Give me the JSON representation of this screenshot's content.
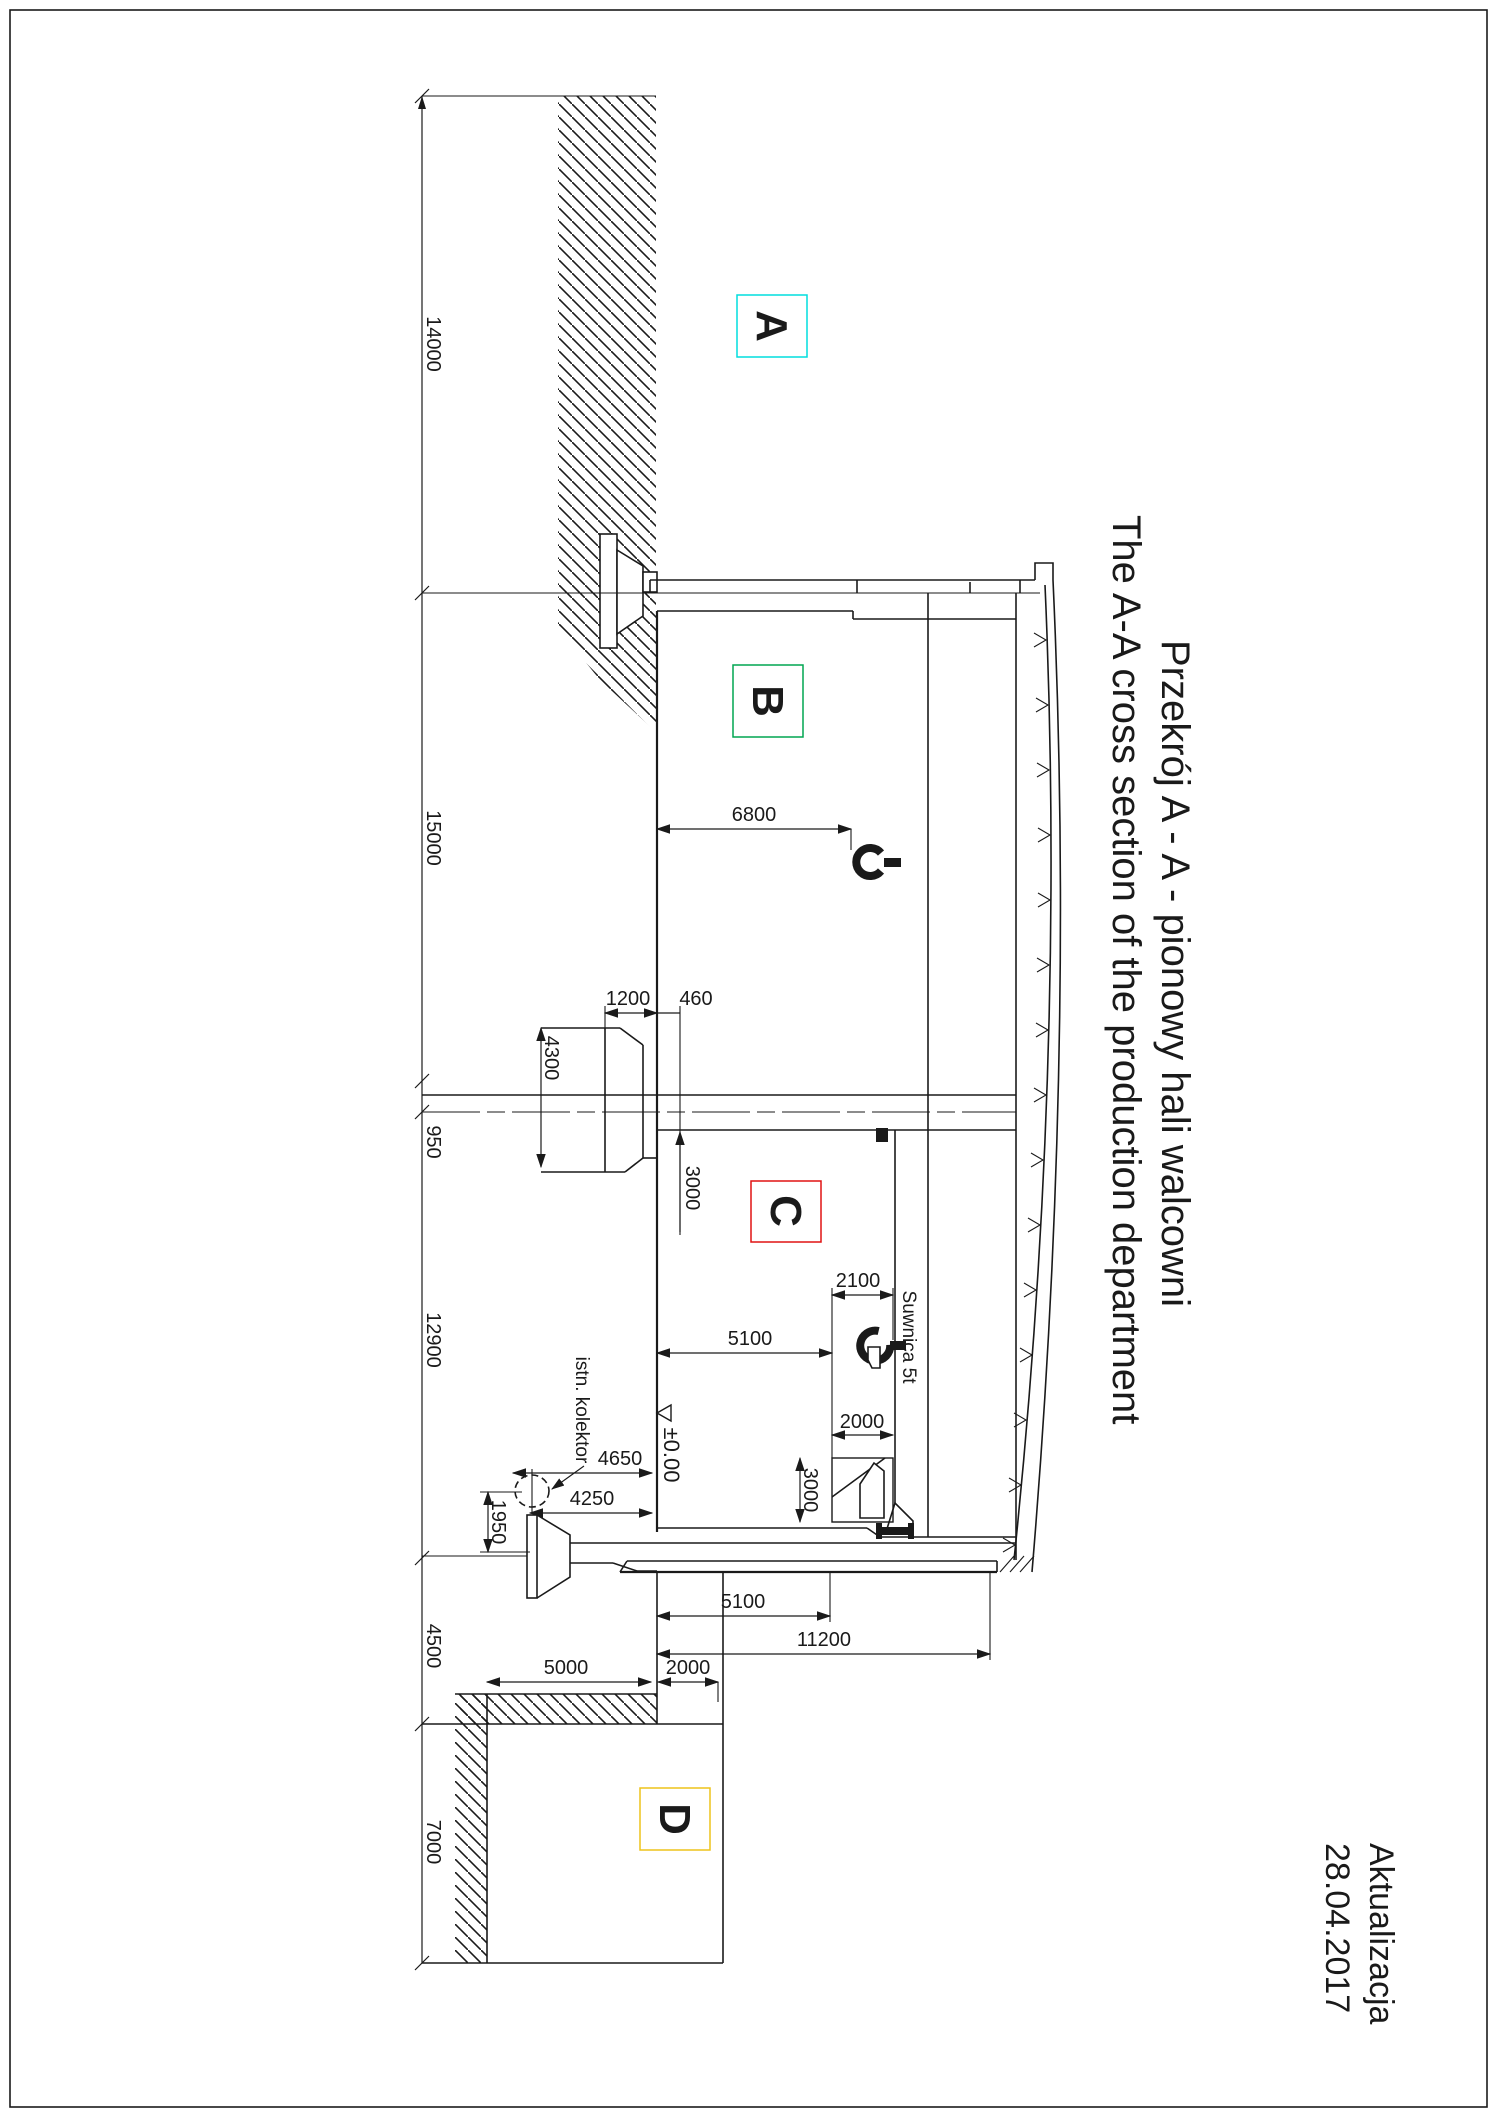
{
  "drawing": {
    "title_pl": "Przekrój A - A - pionowy hali walcowni",
    "title_en": "The A-A cross section of the production department",
    "update_label": "Aktualizacja",
    "update_date": "28.04.2017"
  },
  "zones": {
    "a": {
      "label": "A",
      "color": "#00dedd"
    },
    "b": {
      "label": "B",
      "color": "#00a651"
    },
    "c": {
      "label": "C",
      "color": "#e01212"
    },
    "d": {
      "label": "D",
      "color": "#eec31a"
    }
  },
  "chain_dims": {
    "d14000": "14000",
    "d15000": "15000",
    "d950": "950",
    "d12900": "12900",
    "d4500": "4500",
    "d7000": "7000"
  },
  "dims": {
    "hall_b_span": "6800",
    "col_width": "1200",
    "col_offset": "460",
    "col_height": "4300",
    "beam_drop": "3000",
    "crane_width": "2100",
    "crane_span": "5100",
    "equip_width": "2000",
    "equip_height": "3000",
    "collector_dist": "4650",
    "footing_dist": "4250",
    "collector_depth": "1950",
    "floor_span": "5100",
    "total_span": "11200",
    "annex_width": "5000",
    "passage_width": "2000"
  },
  "labels": {
    "level": "±0.00",
    "collector": "istn. kolektor",
    "crane": "Suwnica 5t"
  }
}
